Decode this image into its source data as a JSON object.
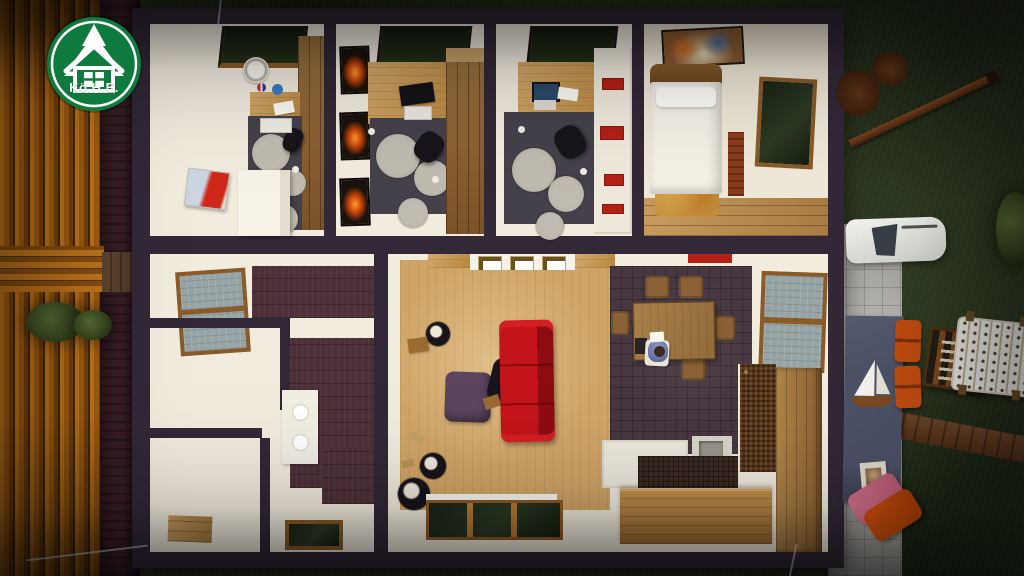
{
  "scene": {
    "description": "3D bird's-eye cutaway render of a single-story house with furnished rooms and landscaped yard",
    "elements": [
      "wood-deck",
      "garden-bed",
      "walkway",
      "house",
      "office-room-1",
      "office-room-2",
      "office-room-3",
      "bedroom",
      "bathroom",
      "kitchen",
      "living-room",
      "dining-area",
      "patio",
      "grill",
      "outdoor-table",
      "sailboat-model",
      "outdoor-chairs",
      "lounge-chair",
      "garden-bench",
      "foosball-table",
      "wood-beam",
      "grass",
      "bushes"
    ]
  },
  "logo": {
    "text": "Kö.H.E."
  },
  "colors": {
    "grass": "#2e3a23",
    "wall": "#322837",
    "white": "#f2ecdf",
    "cream": "#efe8d8",
    "woodFloor": "#d0a568",
    "officeFloor": "#45414a",
    "tileMaroon": "#4e3038",
    "tileDining": "#473740",
    "sofa": "#b01016",
    "ottoman": "#5d4560",
    "patio": "#b4b3ae",
    "navy": "#4c5166",
    "orange": "#c04c10",
    "pink": "#d4728a",
    "glassBlue": "#97a4a6",
    "red": "#b32016",
    "logoGreen": "#0f7a3e"
  }
}
